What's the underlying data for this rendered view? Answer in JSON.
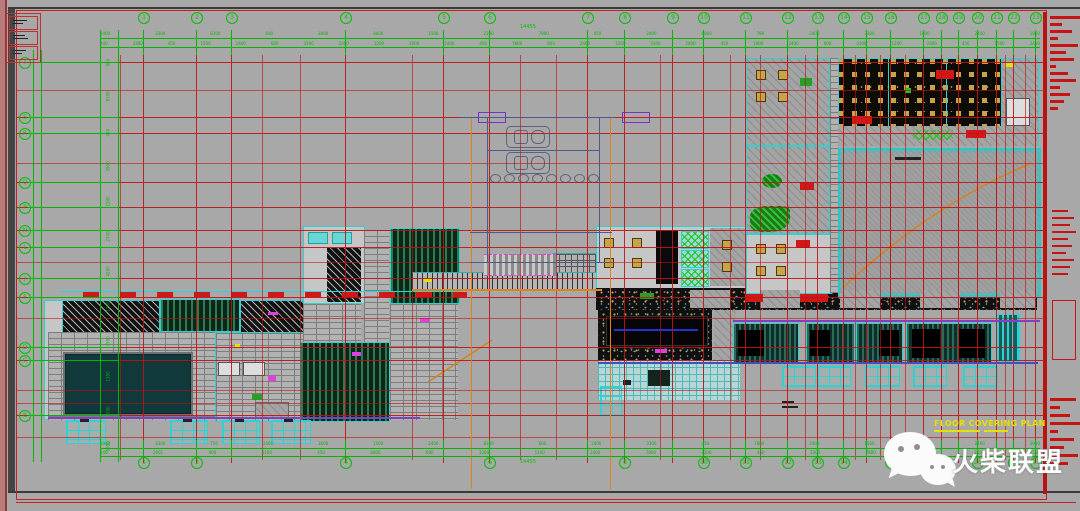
{
  "sheet": {
    "plan_title": "FLOOR COVERING PLAN",
    "background_color": "#a8a8a8",
    "grid_line_color": "#bb1414",
    "dimension_color": "#00b400",
    "accent_cyan": "#2ed2d2",
    "accent_orange": "#e08020",
    "accent_yellow": "#e8e000",
    "accent_red": "#d01818"
  },
  "watermark": {
    "text": "火柴联盟",
    "icon": "wechat-icon"
  },
  "grid": {
    "top_total": "14455",
    "bottom_total": "14455",
    "columns": [
      {
        "label": "1",
        "x": 143,
        "bottom": true
      },
      {
        "label": "2",
        "x": 196,
        "bottom": true
      },
      {
        "label": "3",
        "x": 231,
        "bottom": false
      },
      {
        "label": "4",
        "x": 345,
        "bottom": true
      },
      {
        "label": "5",
        "x": 443,
        "bottom": false
      },
      {
        "label": "6",
        "x": 489,
        "bottom": true
      },
      {
        "label": "7",
        "x": 587,
        "bottom": false
      },
      {
        "label": "8",
        "x": 624,
        "bottom": true
      },
      {
        "label": "9",
        "x": 672,
        "bottom": false
      },
      {
        "label": "10",
        "x": 703,
        "bottom": true
      },
      {
        "label": "11",
        "x": 745,
        "bottom": true
      },
      {
        "label": "12",
        "x": 787,
        "bottom": true
      },
      {
        "label": "13",
        "x": 817,
        "bottom": true
      },
      {
        "label": "14",
        "x": 843,
        "bottom": true
      },
      {
        "label": "15",
        "x": 866,
        "bottom": false
      },
      {
        "label": "16",
        "x": 890,
        "bottom": true
      },
      {
        "label": "17",
        "x": 923,
        "bottom": true
      },
      {
        "label": "18",
        "x": 941,
        "bottom": true
      },
      {
        "label": "19",
        "x": 958,
        "bottom": false
      },
      {
        "label": "20",
        "x": 977,
        "bottom": true
      },
      {
        "label": "21",
        "x": 996,
        "bottom": false
      },
      {
        "label": "22",
        "x": 1013,
        "bottom": true
      },
      {
        "label": "23",
        "x": 1035,
        "bottom": true
      }
    ],
    "rows": [
      {
        "label": "T",
        "y": 62
      },
      {
        "label": "S",
        "y": 117
      },
      {
        "label": "R",
        "y": 133
      },
      {
        "label": "Q",
        "y": 182
      },
      {
        "label": "P",
        "y": 207
      },
      {
        "label": "N",
        "y": 230
      },
      {
        "label": "L",
        "y": 247
      },
      {
        "label": "J",
        "y": 278
      },
      {
        "label": "F",
        "y": 297
      },
      {
        "label": "D",
        "y": 347
      },
      {
        "label": "C",
        "y": 360
      },
      {
        "label": "B",
        "y": 415
      }
    ]
  },
  "dimensions": {
    "top_row1": [
      "2400",
      "3300",
      "8100",
      "600",
      "3000",
      "8400",
      "1500",
      "2100",
      "7800",
      "450",
      "2400",
      "9000",
      "780",
      "2400",
      "3300",
      "1800",
      "2400",
      "1950"
    ],
    "top_row2": [
      "240",
      "3300",
      "450",
      "1500",
      "2400",
      "600",
      "3300",
      "2400",
      "1200",
      "3000",
      "2400",
      "450",
      "7800",
      "600",
      "2400",
      "1500",
      "3300",
      "2400",
      "450",
      "1800",
      "2400",
      "600",
      "3300",
      "1200",
      "2400",
      "450",
      "1500",
      "2400"
    ],
    "bottom_row1": [
      "2040",
      "3300",
      "750",
      "2400",
      "3600",
      "1500",
      "2400",
      "8100",
      "600",
      "2400",
      "3300",
      "450",
      "7800",
      "2400",
      "1500",
      "3300",
      "2400",
      "1950"
    ],
    "bottom_row2": [
      "240",
      "2001",
      "900",
      "5100",
      "450",
      "8400",
      "600",
      "3300",
      "5100",
      "2400",
      "7800",
      "1200",
      "450",
      "3300",
      "7800",
      "600",
      "2400",
      "1500"
    ],
    "left_col": [
      "900",
      "8100",
      "450",
      "3900",
      "1500",
      "2700",
      "4200",
      "1200",
      "7500",
      "1350",
      "1050",
      "5550"
    ]
  }
}
